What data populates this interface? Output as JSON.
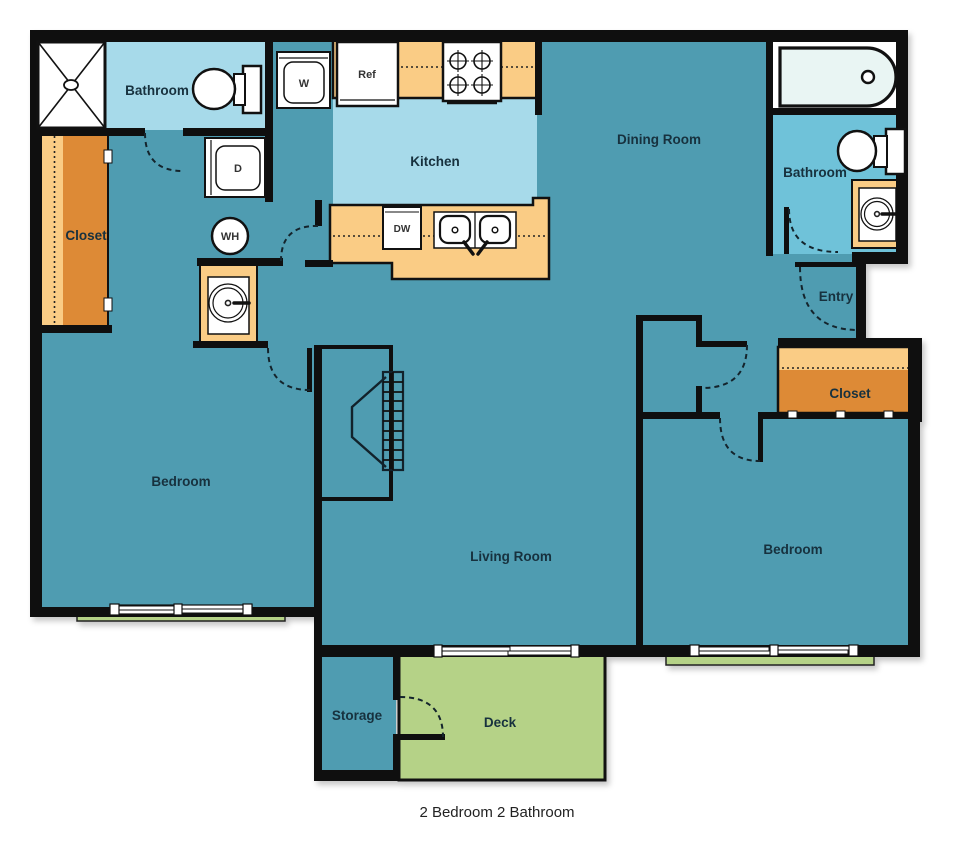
{
  "title": "2 Bedroom 2 Bathroom",
  "rooms": {
    "bathroom_left": "Bathroom",
    "closet_left": "Closet",
    "kitchen": "Kitchen",
    "dining_room": "Dining Room",
    "bathroom_right": "Bathroom",
    "entry": "Entry",
    "closet_right": "Closet",
    "bedroom_left": "Bedroom",
    "living_room": "Living Room",
    "bedroom_right": "Bedroom",
    "storage": "Storage",
    "deck": "Deck"
  },
  "appliances": {
    "washer": "W",
    "dryer": "D",
    "water_heater": "WH",
    "refrigerator": "Ref",
    "dishwasher": "DW"
  },
  "colors": {
    "floor_teal": "#4F9CB1",
    "room_light_blue": "#A7DAEA",
    "bath_blue": "#6FC2D9",
    "closet_orange": "#DD8A36",
    "counter_orange": "#FACC85",
    "deck_green": "#B5D287",
    "wall_black": "#0F0F0F",
    "fixture_white": "#FFFFFF",
    "tub_inner": "#E9F5F3",
    "label_text": "#17313E"
  }
}
